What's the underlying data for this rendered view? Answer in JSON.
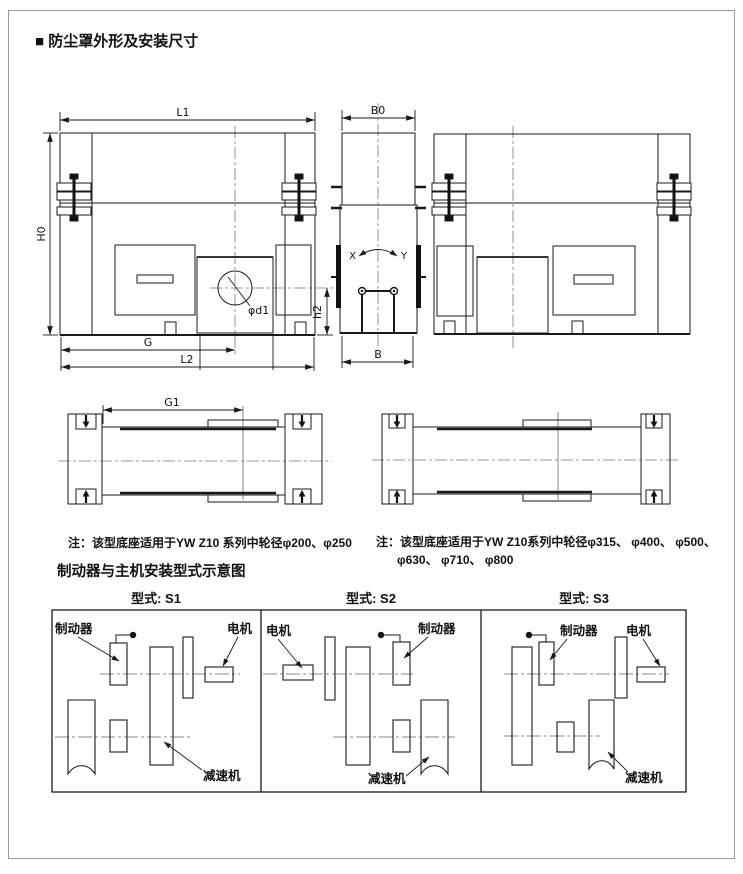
{
  "colors": {
    "line": "#1a1a1a",
    "centerline": "#777777",
    "axis": "#888888",
    "border": "#999999",
    "background": "#ffffff"
  },
  "header": {
    "title": "■ 防尘罩外形及安装尺寸"
  },
  "drawing": {
    "front_left": {
      "l1": "L1",
      "h0": "H0",
      "g": "G",
      "l2": "L2",
      "phi_d1": "φd1",
      "h2": "h2"
    },
    "side": {
      "b0": "B0",
      "b": "B",
      "x": "X",
      "y": "Y"
    },
    "top_left": {
      "g1": "G1"
    }
  },
  "notes": {
    "left": "注：该型底座适用于YW Z10 系列中轮径φ200、φ250",
    "right_line1": "注：该型底座适用于YW Z10系列中轮径φ315、 φ400、 φ500、",
    "right_line2": "φ630、 φ710、 φ800"
  },
  "section": {
    "title": "制动器与主机安装型式示意图"
  },
  "types": {
    "s1": {
      "header": "型式: S1",
      "brake": "制动器",
      "motor": "电机",
      "reducer": "减速机"
    },
    "s2": {
      "header": "型式: S2",
      "brake": "制动器",
      "motor": "电机",
      "reducer": "减速机"
    },
    "s3": {
      "header": "型式: S3",
      "brake": "制动器",
      "motor": "电机",
      "reducer": "减速机"
    }
  }
}
